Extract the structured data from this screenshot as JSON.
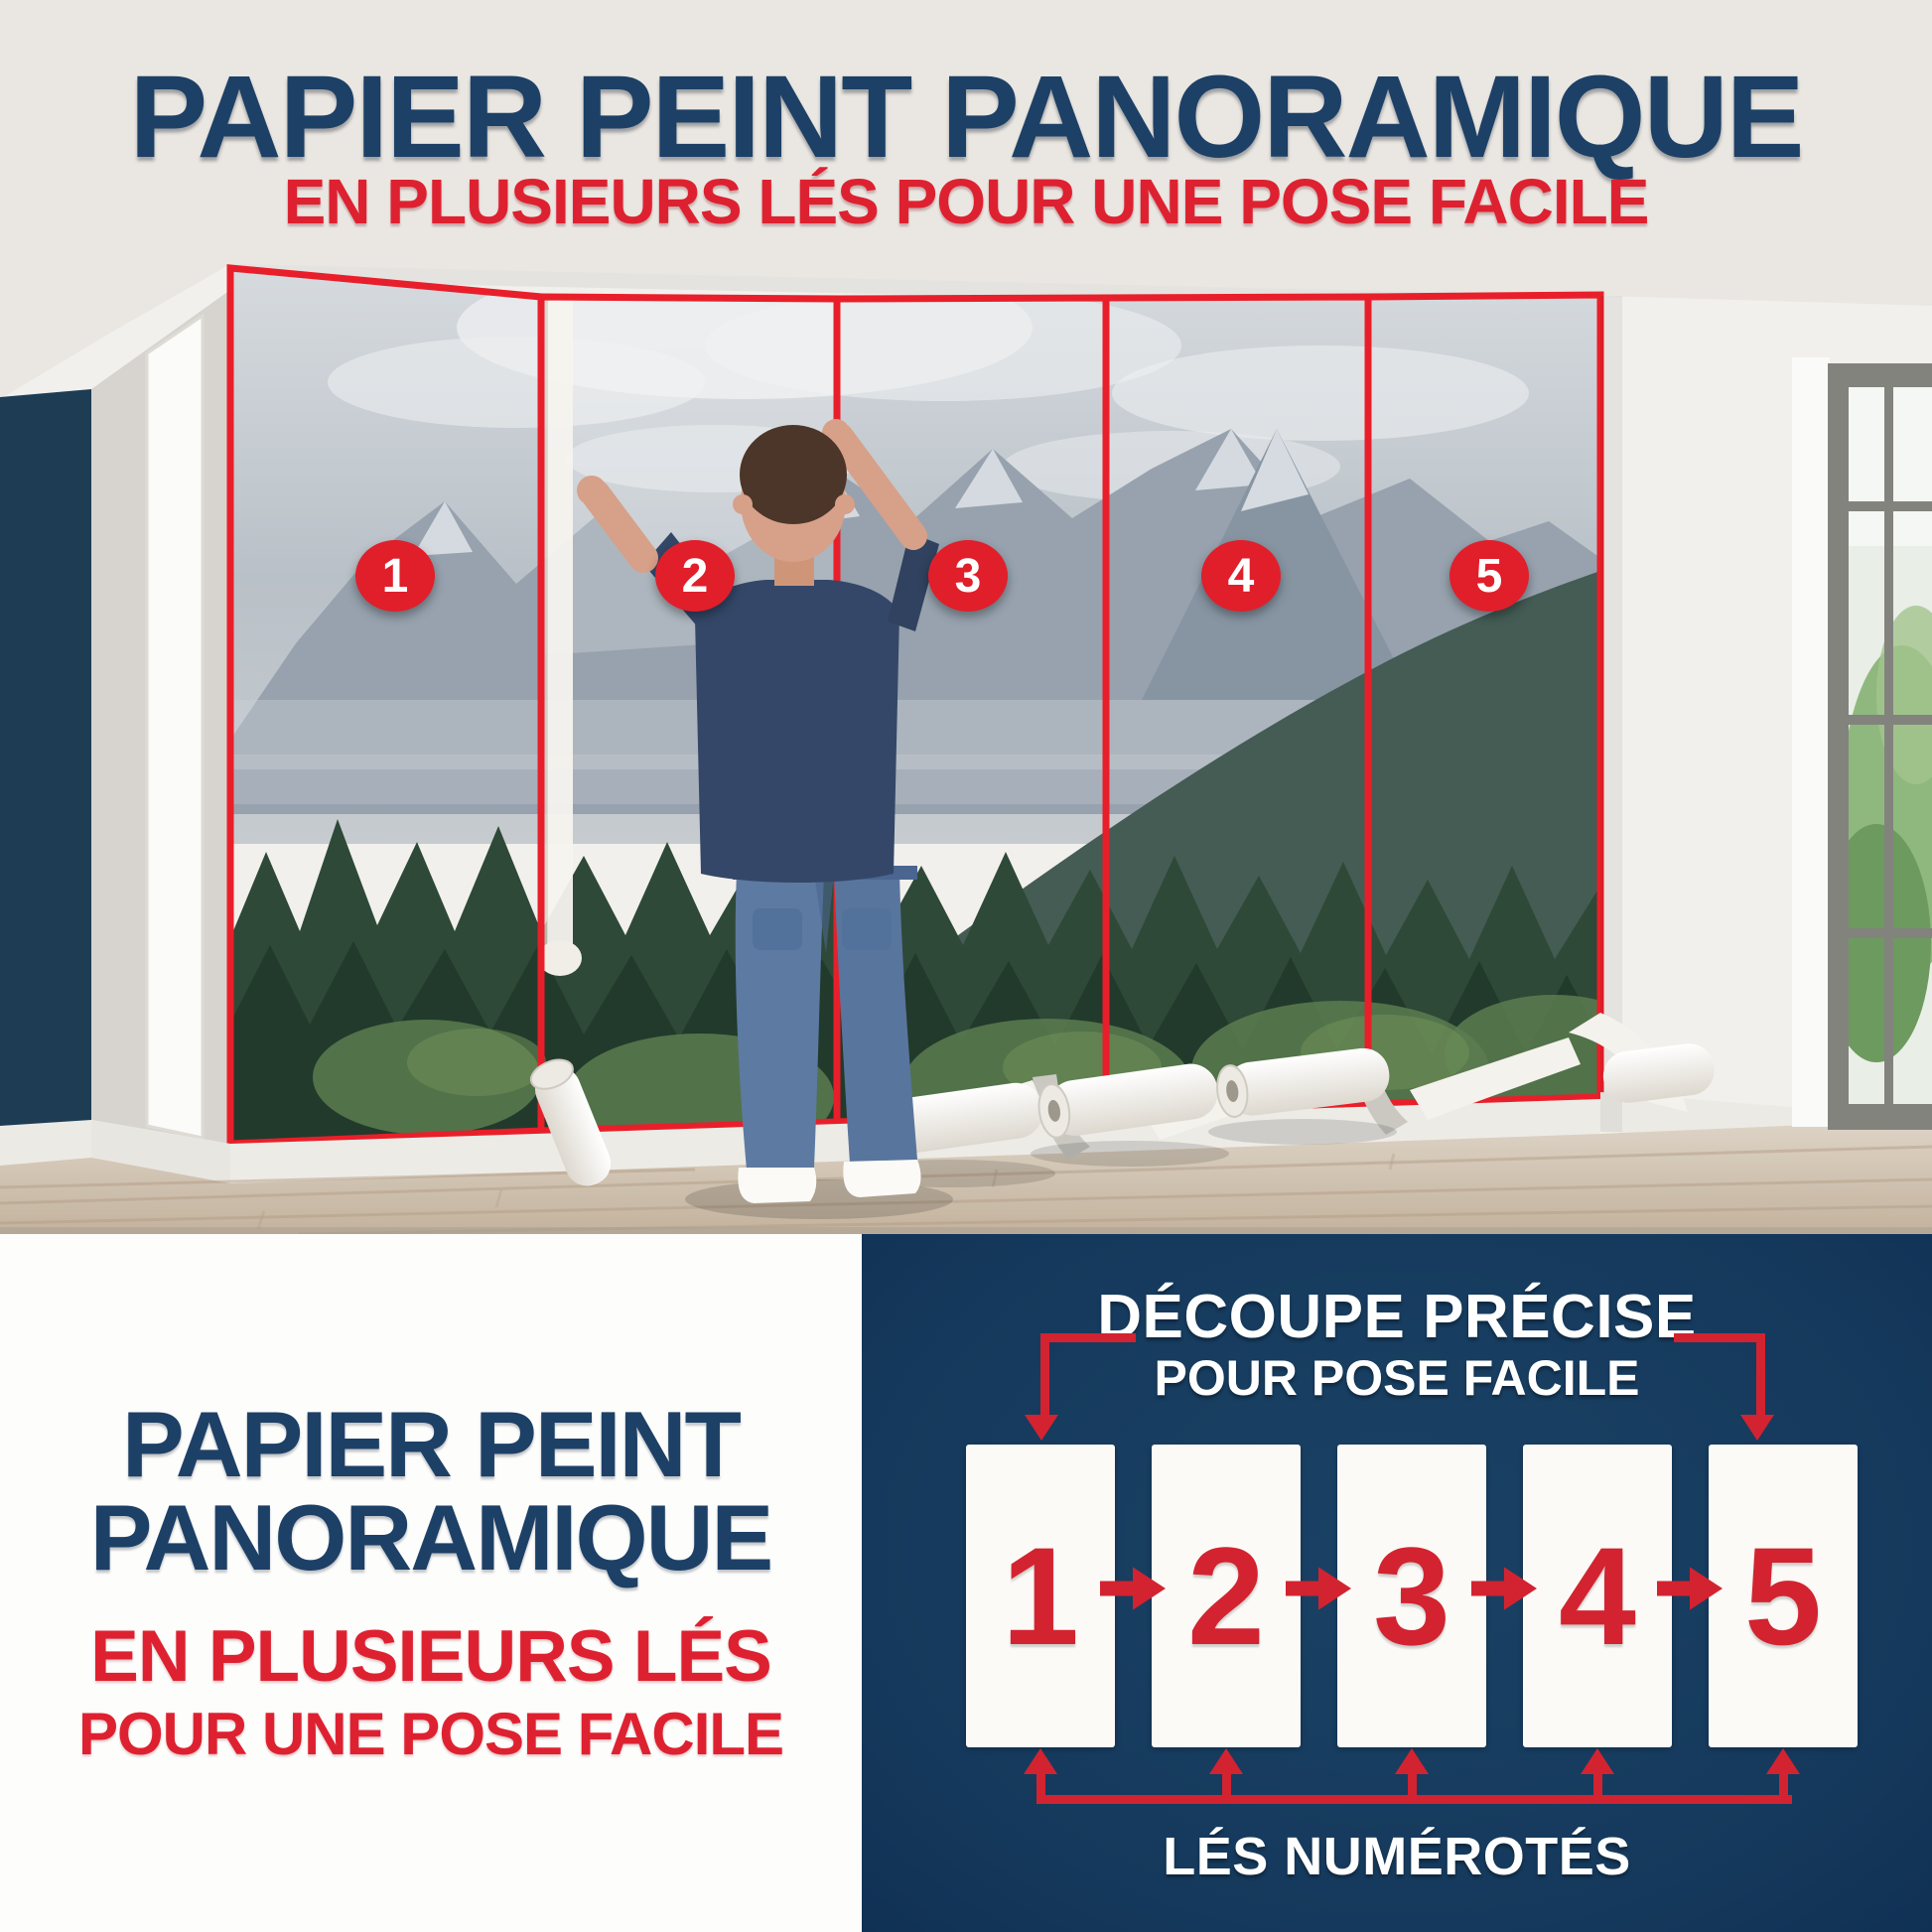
{
  "colors": {
    "navy": "#1d4066",
    "red": "#de2130",
    "red2": "#d32330",
    "badge_red": "#e01f2b",
    "diagram_bg": "#15395c",
    "panel_white": "#fbfaf7",
    "accent_wall": "#1e3d55"
  },
  "header": {
    "title": "PAPIER PEINT PANORAMIQUE",
    "subtitle": "EN PLUSIEURS LÉS POUR UNE POSE FACILE"
  },
  "photo": {
    "badges": [
      "1",
      "2",
      "3",
      "4",
      "5"
    ]
  },
  "bottom_left": {
    "title_line1": "PAPIER PEINT",
    "title_line2": "PANORAMIQUE",
    "subtitle_line1": "EN PLUSIEURS LÉS",
    "subtitle_line2": "POUR UNE POSE FACILE"
  },
  "diagram": {
    "title_line1": "DÉCOUPE PRÉCISE",
    "title_line2": "POUR POSE FACILE",
    "panels": [
      "1",
      "2",
      "3",
      "4",
      "5"
    ],
    "caption": "LÉS NUMÉROTÉS"
  }
}
